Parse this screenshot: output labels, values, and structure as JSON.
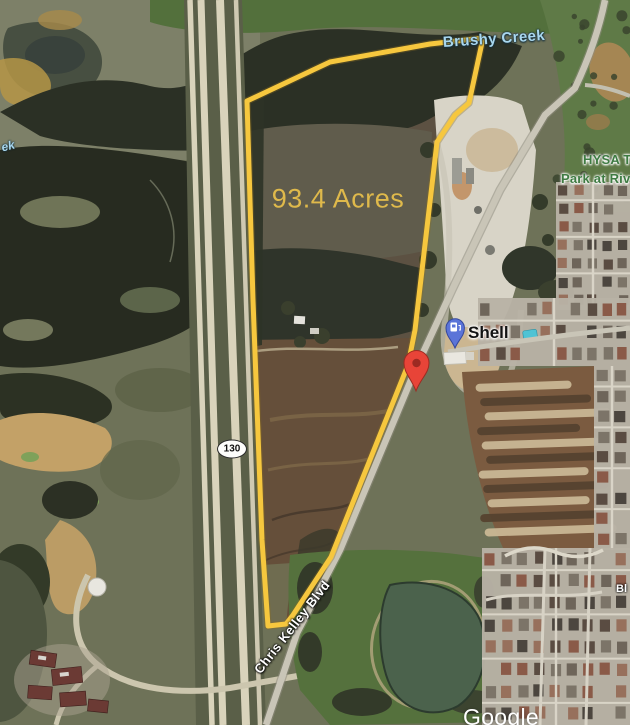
{
  "map": {
    "parcel": {
      "acreage_label": "93.4 Acres",
      "outline_color": "#f6c73e"
    },
    "labels": {
      "creek": "Brushy Creek",
      "creek_partial": "ek",
      "park_line1": "HYSA T",
      "park_line2": "Park at Riv",
      "gas_station": "Shell",
      "highway_shield": "130",
      "road": "Chris Kelley Blvd",
      "street_partial": "Bl",
      "watermark": "Google"
    },
    "markers": {
      "shell_pin": "gas-station-pin",
      "red_marker": "property-location-marker"
    },
    "colors": {
      "acreage_text": "#dfb94b",
      "creek_text": "#a9d7ee",
      "park_text": "#3e7b42",
      "marker_red": "#e84438",
      "marker_red_dark": "#9e2b22",
      "pin_blue": "#5b74d8",
      "pin_blue_dark": "#34489c"
    }
  }
}
